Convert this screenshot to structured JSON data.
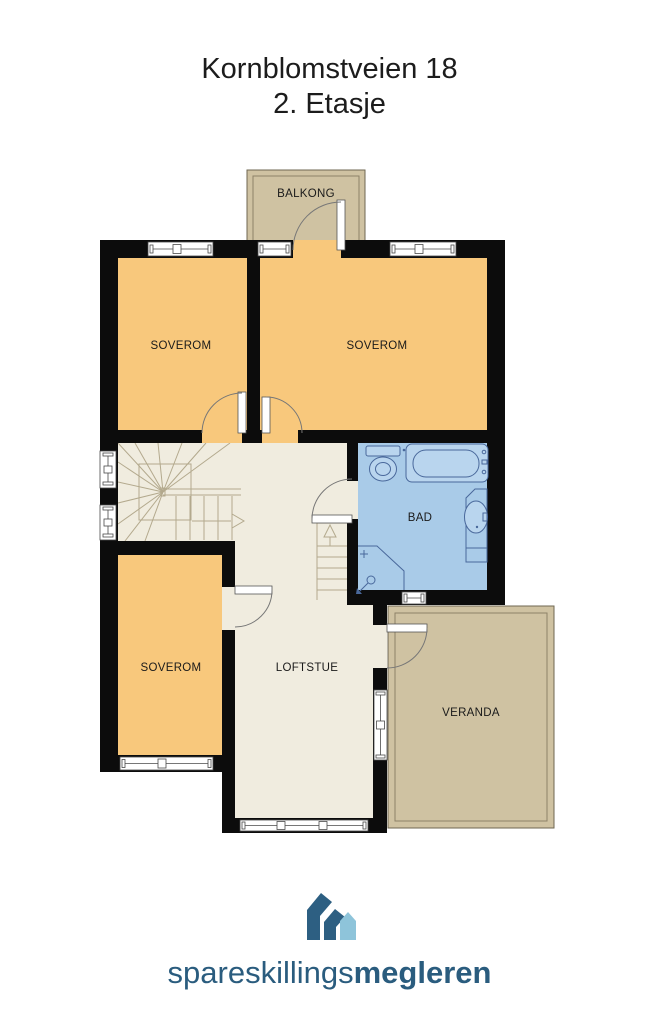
{
  "title": {
    "address": "Kornblomstveien 18",
    "floor": "2. Etasje"
  },
  "plan": {
    "labels": {
      "balkong": "BALKONG",
      "soverom_top_left": "SOVEROM",
      "soverom_top_right": "SOVEROM",
      "bad": "BAD",
      "soverom_bottom": "SOVEROM",
      "loftstue": "LOFTSTUE",
      "veranda": "VERANDA"
    },
    "colors": {
      "bedroom_fill": "#f8c87c",
      "living_fill": "#f0ecdf",
      "bathroom_fill": "#a9cbe8",
      "outdoor_fill": "#cfc2a2",
      "wall": "#0c0c0c"
    }
  },
  "logo": {
    "brand_regular": "spareskillings",
    "brand_bold": "megleren",
    "brand_color": "#2a5c7e",
    "house_dark": "#2d5f82",
    "house_light": "#8ec4da"
  }
}
